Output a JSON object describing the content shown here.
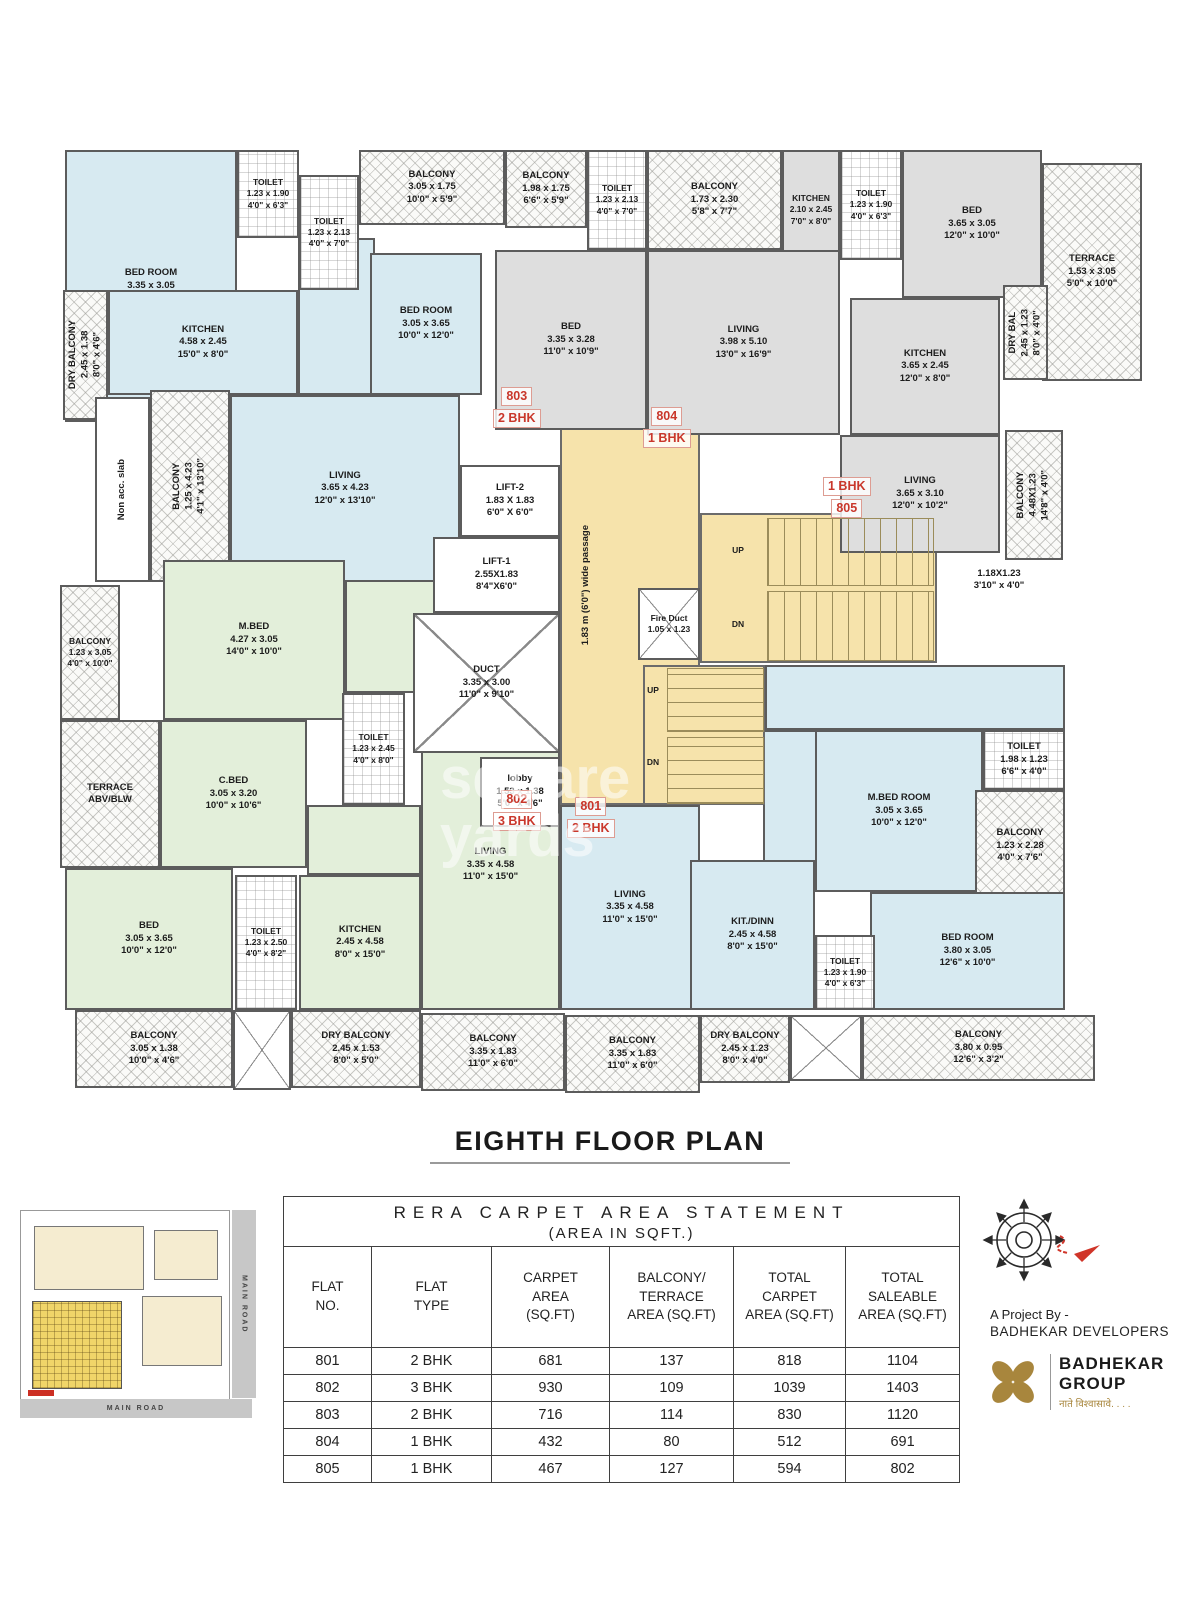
{
  "page": {
    "title": "EIGHTH FLOOR PLAN"
  },
  "watermark": {
    "text": "square\nyards"
  },
  "plan": {
    "rooms": [
      {
        "id": "room-803-dining-area",
        "t": "",
        "x": 243,
        "y": 103,
        "w": 77,
        "h": 157,
        "f": "blue"
      },
      {
        "id": "room-802-hall-area",
        "t": "",
        "x": 290,
        "y": 425,
        "w": 215,
        "h": 133,
        "f": "green"
      },
      {
        "id": "room-802-passage-area",
        "t": "",
        "x": 252,
        "y": 670,
        "w": 114,
        "h": 70,
        "f": "green"
      },
      {
        "id": "room-801-hall-area",
        "t": "",
        "x": 710,
        "y": 530,
        "w": 300,
        "h": 65,
        "f": "blue"
      },
      {
        "id": "room-801-dining-area",
        "t": "",
        "x": 708,
        "y": 595,
        "w": 54,
        "h": 132,
        "f": "blue"
      },
      {
        "id": "corridor-passage",
        "t": "",
        "x": 505,
        "y": 245,
        "w": 140,
        "h": 425,
        "f": "yellow"
      },
      {
        "id": "stair-hall",
        "t": "",
        "x": 645,
        "y": 378,
        "w": 237,
        "h": 150,
        "f": "yellow"
      },
      {
        "id": "stairs-lower-block",
        "t": "",
        "x": 588,
        "y": 530,
        "w": 122,
        "h": 140,
        "f": "yellow"
      },
      {
        "id": "room-803-bedroom-1",
        "t": "BED ROOM\n3.35 x 3.05\n11'0\" x 10'0\"",
        "x": 10,
        "y": 15,
        "w": 172,
        "h": 272,
        "f": "blue"
      },
      {
        "id": "room-803-toilet-1",
        "t": "TOILET\n1.23 x 1.90\n4'0\" x 6'3\"",
        "x": 182,
        "y": 15,
        "w": 62,
        "h": 88,
        "f": "tile"
      },
      {
        "id": "room-803-toilet-2",
        "t": "TOILET\n1.23 x 2.13\n4'0\" x 7'0\"",
        "x": 244,
        "y": 40,
        "w": 60,
        "h": 115,
        "f": "tile"
      },
      {
        "id": "room-803-balcony-top",
        "t": "BALCONY\n3.05 x 1.75\n10'0\" x 5'9\"",
        "x": 304,
        "y": 15,
        "w": 146,
        "h": 75,
        "f": "hatch"
      },
      {
        "id": "room-803-dry-balcony",
        "t": "DRY BALCONY\n2.45 x 1.38\n8'0\" x 4'6\"",
        "x": 8,
        "y": 155,
        "w": 45,
        "h": 130,
        "f": "hatch",
        "v": 1
      },
      {
        "id": "room-803-kitchen",
        "t": "KITCHEN\n4.58 x 2.45\n15'0\" x 8'0\"",
        "x": 53,
        "y": 155,
        "w": 190,
        "h": 105,
        "f": "blue"
      },
      {
        "id": "room-803-bedroom-2",
        "t": "BED ROOM\n3.05 x 3.65\n10'0\" x 12'0\"",
        "x": 315,
        "y": 118,
        "w": 112,
        "h": 142,
        "f": "blue"
      },
      {
        "id": "room-803-living",
        "t": "LIVING\n3.65 x 4.23\n12'0\" x 13'10\"",
        "x": 175,
        "y": 260,
        "w": 230,
        "h": 187,
        "f": "blue"
      },
      {
        "id": "non-acc-slab",
        "t": "Non acc. slab",
        "x": 40,
        "y": 262,
        "w": 55,
        "h": 185,
        "f": "white",
        "v": 1
      },
      {
        "id": "room-803-balcony-left",
        "t": "BALCONY\n1.25 x 4.23\n4'1\" x 13'10\"",
        "x": 95,
        "y": 255,
        "w": 80,
        "h": 192,
        "f": "hatch",
        "v": 1
      },
      {
        "id": "room-804-balcony-1",
        "t": "BALCONY\n1.98 x 1.75\n6'6\" x 5'9\"",
        "x": 450,
        "y": 15,
        "w": 82,
        "h": 78,
        "f": "hatch"
      },
      {
        "id": "room-804-toilet",
        "t": "TOILET\n1.23 x 2.13\n4'0\" x 7'0\"",
        "x": 532,
        "y": 15,
        "w": 60,
        "h": 100,
        "f": "tile"
      },
      {
        "id": "room-804-balcony-2",
        "t": "BALCONY\n1.73 x 2.30\n5'8\" x 7'7\"",
        "x": 592,
        "y": 15,
        "w": 135,
        "h": 100,
        "f": "hatch"
      },
      {
        "id": "room-804-kitchen",
        "t": "KITCHEN\n2.10 x 2.45\n7'0\" x 8'0\"",
        "x": 727,
        "y": 15,
        "w": 58,
        "h": 120,
        "f": "gray"
      },
      {
        "id": "room-804-bed",
        "t": "BED\n3.35 x 3.28\n11'0\" x 10'9\"",
        "x": 440,
        "y": 115,
        "w": 152,
        "h": 180,
        "f": "gray"
      },
      {
        "id": "room-804-living",
        "t": "LIVING\n3.98 x 5.10\n13'0\" x 16'9\"",
        "x": 592,
        "y": 115,
        "w": 193,
        "h": 185,
        "f": "gray"
      },
      {
        "id": "room-805-toilet",
        "t": "TOILET\n1.23 x 1.90\n4'0\" x 6'3\"",
        "x": 785,
        "y": 15,
        "w": 62,
        "h": 110,
        "f": "tile"
      },
      {
        "id": "room-805-bed",
        "t": "BED\n3.65 x 3.05\n12'0\" x 10'0\"",
        "x": 847,
        "y": 15,
        "w": 140,
        "h": 148,
        "f": "gray"
      },
      {
        "id": "room-805-terrace",
        "t": "TERRACE\n1.53 x 3.05\n5'0\" x 10'0\"",
        "x": 987,
        "y": 28,
        "w": 100,
        "h": 218,
        "f": "hatch"
      },
      {
        "id": "room-805-kitchen",
        "t": "KITCHEN\n3.65 x 2.45\n12'0\" x 8'0\"",
        "x": 795,
        "y": 163,
        "w": 150,
        "h": 137,
        "f": "gray"
      },
      {
        "id": "room-805-dry-balcony",
        "t": "DRY BAL\n2.45 x 1.23\n8'0\" x 4'0\"",
        "x": 948,
        "y": 150,
        "w": 45,
        "h": 95,
        "f": "hatch",
        "v": 1
      },
      {
        "id": "room-805-living",
        "t": "LIVING\n3.65 x 3.10\n12'0\" x 10'2\"",
        "x": 785,
        "y": 300,
        "w": 160,
        "h": 118,
        "f": "gray"
      },
      {
        "id": "room-805-balcony",
        "t": "BALCONY\n4.48X1.23\n14'8\" x 4'0\"",
        "x": 950,
        "y": 295,
        "w": 58,
        "h": 130,
        "f": "hatch",
        "v": 1
      },
      {
        "id": "room-802-mbed",
        "t": "M.BED\n4.27 x 3.05\n14'0\" x 10'0\"",
        "x": 108,
        "y": 425,
        "w": 182,
        "h": 160,
        "f": "green"
      },
      {
        "id": "room-802-balcony-left",
        "t": "BALCONY\n1.23 x 3.05\n4'0\" x 10'0\"",
        "x": 5,
        "y": 450,
        "w": 60,
        "h": 135,
        "f": "hatch"
      },
      {
        "id": "room-802-terrace",
        "t": "TERRACE\nABV/BLW",
        "x": 5,
        "y": 585,
        "w": 100,
        "h": 148,
        "f": "hatch"
      },
      {
        "id": "room-802-cbed",
        "t": "C.BED\n3.05 x 3.20\n10'0\" x 10'6\"",
        "x": 105,
        "y": 585,
        "w": 147,
        "h": 148,
        "f": "green"
      },
      {
        "id": "room-802-toilet-1",
        "t": "TOILET\n1.23 x 2.45\n4'0\" x 8'0\"",
        "x": 287,
        "y": 558,
        "w": 63,
        "h": 112,
        "f": "tile"
      },
      {
        "id": "room-802-bed",
        "t": "BED\n3.05 x 3.65\n10'0\" x 12'0\"",
        "x": 10,
        "y": 733,
        "w": 168,
        "h": 142,
        "f": "green"
      },
      {
        "id": "room-802-toilet-2",
        "t": "TOILET\n1.23 x 2.50\n4'0\" x 8'2\"",
        "x": 180,
        "y": 740,
        "w": 62,
        "h": 135,
        "f": "tile"
      },
      {
        "id": "room-802-kitchen",
        "t": "KITCHEN\n2.45 x 4.58\n8'0\" x 15'0\"",
        "x": 244,
        "y": 740,
        "w": 122,
        "h": 135,
        "f": "green"
      },
      {
        "id": "room-802-living",
        "t": "LIVING\n3.35 x 4.58\n11'0\" x 15'0\"",
        "x": 366,
        "y": 585,
        "w": 139,
        "h": 290,
        "f": "green"
      },
      {
        "id": "room-801-living",
        "t": "LIVING\n3.35 x 4.58\n11'0\" x 15'0\"",
        "x": 505,
        "y": 670,
        "w": 140,
        "h": 205,
        "f": "blue"
      },
      {
        "id": "room-801-mbed",
        "t": "M.BED ROOM\n3.05 x 3.65\n10'0\" x 12'0\"",
        "x": 760,
        "y": 595,
        "w": 168,
        "h": 162,
        "f": "blue"
      },
      {
        "id": "room-801-toilet-1",
        "t": "TOILET\n1.98 x 1.23\n6'6\" x 4'0\"",
        "x": 928,
        "y": 595,
        "w": 82,
        "h": 60,
        "f": "tile"
      },
      {
        "id": "room-801-balcony",
        "t": "BALCONY\n1.23 x 2.28\n4'0\" x 7'6\"",
        "x": 920,
        "y": 655,
        "w": 90,
        "h": 112,
        "f": "hatch"
      },
      {
        "id": "room-801-bedroom",
        "t": "BED ROOM\n3.80 x 3.05\n12'6\" x 10'0\"",
        "x": 815,
        "y": 757,
        "w": 195,
        "h": 118,
        "f": "blue"
      },
      {
        "id": "room-801-toilet-2",
        "t": "TOILET\n1.23 x 1.90\n4'0\" x 6'3\"",
        "x": 760,
        "y": 800,
        "w": 60,
        "h": 75,
        "f": "tile"
      },
      {
        "id": "room-801-kitdinn",
        "t": "KIT./DINN\n2.45 x 4.58\n8'0\" x 15'0\"",
        "x": 635,
        "y": 725,
        "w": 125,
        "h": 150,
        "f": "blue"
      },
      {
        "id": "lift-2",
        "t": "LIFT-2\n1.83 X 1.83\n6'0\" X 6'0\"",
        "x": 405,
        "y": 330,
        "w": 100,
        "h": 72,
        "f": "white"
      },
      {
        "id": "lift-1",
        "t": "LIFT-1\n2.55X1.83\n8'4\"X6'0\"",
        "x": 378,
        "y": 402,
        "w": 127,
        "h": 76,
        "f": "white"
      },
      {
        "id": "duct",
        "t": "DUCT\n3.35 x 3.00\n11'0\" x 9'10\"",
        "x": 358,
        "y": 478,
        "w": 147,
        "h": 140,
        "f": "white",
        "xb": 1
      },
      {
        "id": "fire-duct",
        "t": "Fire Duct\n1.05 x 1.23",
        "x": 583,
        "y": 453,
        "w": 62,
        "h": 72,
        "f": "white",
        "xb": 1
      },
      {
        "id": "lobby",
        "t": "lobby\n1.53 x 1.38\n5'0\" x 4'6\"",
        "x": 425,
        "y": 622,
        "w": 80,
        "h": 70,
        "f": "white"
      },
      {
        "id": "balcony-bottom-1",
        "t": "BALCONY\n3.05 x 1.38\n10'0\" x 4'6\"",
        "x": 20,
        "y": 875,
        "w": 158,
        "h": 78,
        "f": "hatch"
      },
      {
        "id": "service-box-1",
        "t": "",
        "x": 178,
        "y": 875,
        "w": 58,
        "h": 80,
        "f": "white",
        "xb": 1
      },
      {
        "id": "dry-balcony-bottom-1",
        "t": "DRY BALCONY\n2.45 x 1.53\n8'0\" x 5'0\"",
        "x": 236,
        "y": 875,
        "w": 130,
        "h": 78,
        "f": "hatch"
      },
      {
        "id": "balcony-bottom-2",
        "t": "BALCONY\n3.35 x 1.83\n11'0\" x 6'0\"",
        "x": 366,
        "y": 878,
        "w": 144,
        "h": 78,
        "f": "hatch"
      },
      {
        "id": "balcony-bottom-3",
        "t": "BALCONY\n3.35 x 1.83\n11'0\" x 6'0\"",
        "x": 510,
        "y": 880,
        "w": 135,
        "h": 78,
        "f": "hatch"
      },
      {
        "id": "dry-balcony-bottom-2",
        "t": "DRY BALCONY\n2.45 x 1.23\n8'0\" x 4'0\"",
        "x": 645,
        "y": 880,
        "w": 90,
        "h": 68,
        "f": "hatch"
      },
      {
        "id": "service-box-2",
        "t": "",
        "x": 735,
        "y": 880,
        "w": 72,
        "h": 66,
        "f": "white",
        "xb": 1
      },
      {
        "id": "balcony-bottom-4",
        "t": "BALCONY\n3.80 x 0.95\n12'6\" x 3'2\"",
        "x": 807,
        "y": 880,
        "w": 233,
        "h": 66,
        "f": "hatch"
      },
      {
        "id": "stairs-upper-flight-1",
        "x": 712,
        "y": 383,
        "w": 165,
        "h": 66,
        "type": "stairs-v"
      },
      {
        "id": "stairs-upper-flight-2",
        "x": 712,
        "y": 456,
        "w": 165,
        "h": 68,
        "type": "stairs-v"
      },
      {
        "id": "stairs-lower-flight-1",
        "x": 612,
        "y": 533,
        "w": 95,
        "h": 62,
        "type": "stairs-h"
      },
      {
        "id": "stairs-lower-flight-2",
        "x": 612,
        "y": 602,
        "w": 95,
        "h": 65,
        "type": "stairs-h"
      },
      {
        "id": "passage-width-label",
        "t": "1.83 m (6'0\") wide passage",
        "x": 516,
        "y": 290,
        "w": 30,
        "h": 320,
        "type": "text",
        "v": 1
      },
      {
        "id": "stairs-upper-up-label",
        "t": "UP",
        "x": 666,
        "y": 408,
        "w": 34,
        "h": 16,
        "type": "text"
      },
      {
        "id": "stairs-upper-dn-label",
        "t": "DN",
        "x": 666,
        "y": 482,
        "w": 34,
        "h": 16,
        "type": "text"
      },
      {
        "id": "stairs-lower-up-label",
        "t": "UP",
        "x": 584,
        "y": 548,
        "w": 28,
        "h": 15,
        "type": "text"
      },
      {
        "id": "stairs-lower-dn-label",
        "t": "DN",
        "x": 584,
        "y": 620,
        "w": 28,
        "h": 15,
        "type": "text"
      },
      {
        "id": "terrace-dim-label",
        "t": "1.18X1.23\n3'10\" x 4'0\"",
        "x": 898,
        "y": 428,
        "w": 92,
        "h": 34,
        "type": "text"
      },
      {
        "id": "flat-label-803",
        "lines": [
          "803",
          "2 BHK"
        ],
        "x": 438,
        "y": 252,
        "type": "flat"
      },
      {
        "id": "flat-label-804",
        "lines": [
          "804",
          "1 BHK"
        ],
        "x": 588,
        "y": 272,
        "type": "flat"
      },
      {
        "id": "flat-label-805",
        "lines": [
          "1 BHK",
          "805"
        ],
        "x": 768,
        "y": 342,
        "type": "flat"
      },
      {
        "id": "flat-label-802",
        "lines": [
          "802",
          "3 BHK"
        ],
        "x": 438,
        "y": 655,
        "type": "flat"
      },
      {
        "id": "flat-label-801",
        "lines": [
          "801",
          "2 BHK"
        ],
        "x": 512,
        "y": 662,
        "type": "flat"
      }
    ]
  },
  "table": {
    "title": "RERA CARPET AREA STATEMENT",
    "subtitle": "(AREA IN SQFT.)",
    "headers": [
      "FLAT\nNO.",
      "FLAT\nTYPE",
      "CARPET\nAREA\n(SQ.FT)",
      "BALCONY/\nTERRACE\nAREA (SQ.FT)",
      "TOTAL\nCARPET\nAREA (SQ.FT)",
      "TOTAL\nSALEABLE\nAREA (SQ.FT)"
    ],
    "rows": [
      [
        "801",
        "2 BHK",
        "681",
        "137",
        "818",
        "1104"
      ],
      [
        "802",
        "3 BHK",
        "930",
        "109",
        "1039",
        "1403"
      ],
      [
        "803",
        "2 BHK",
        "716",
        "114",
        "830",
        "1120"
      ],
      [
        "804",
        "1 BHK",
        "432",
        "80",
        "512",
        "691"
      ],
      [
        "805",
        "1 BHK",
        "467",
        "127",
        "594",
        "802"
      ]
    ]
  },
  "branding": {
    "project_by": "A Project By -",
    "developer": "BADHEKAR DEVELOPERS",
    "brand_name": "BADHEKAR",
    "brand_sub": "GROUP",
    "tagline": "नाते विश्वासावे. . . ."
  },
  "site_plan": {
    "road_right": "MAIN ROAD",
    "road_bottom": "MAIN ROAD"
  },
  "colors": {
    "flat_blue": "#d7eaf1",
    "flat_gray": "#dedede",
    "flat_green": "#e3efda",
    "core_yellow": "#f6e3ab",
    "flat_label_red": "#c9372b",
    "logo_gold": "#a8863d"
  }
}
